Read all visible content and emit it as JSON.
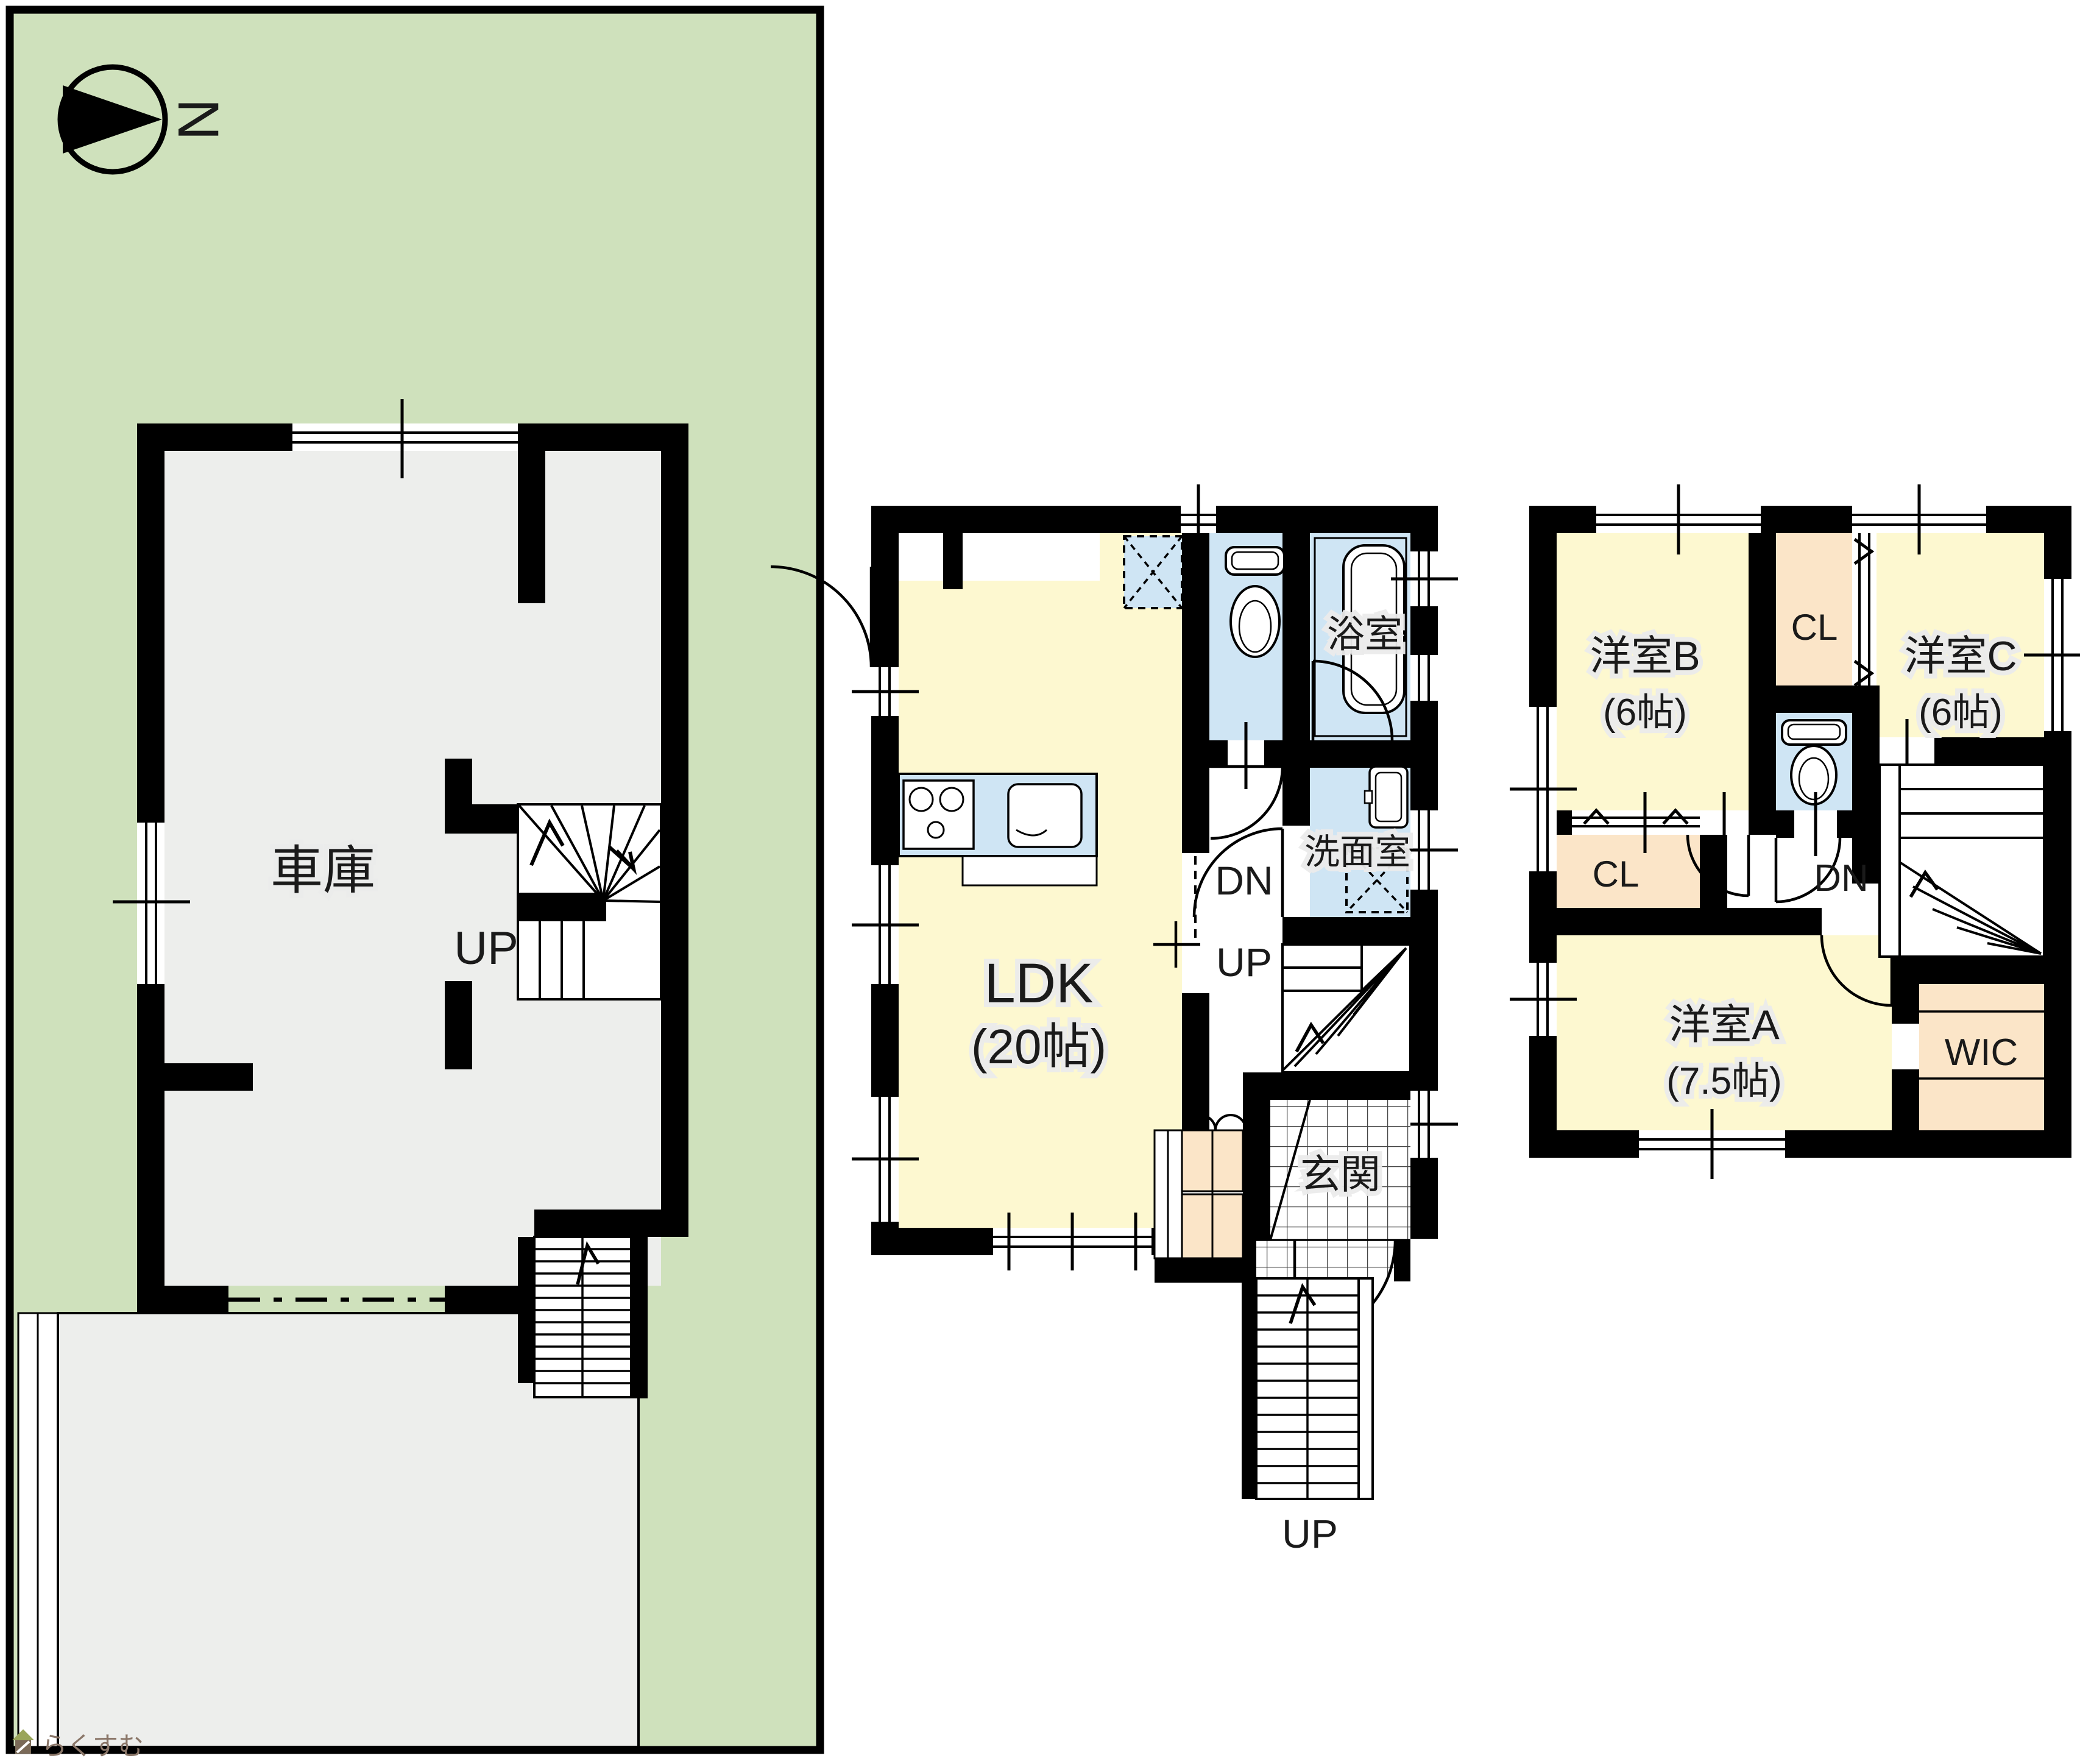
{
  "compass": {
    "north_label": "N"
  },
  "garage_plan": {
    "room_label": "車庫",
    "stair_label": "UP"
  },
  "first_floor_plan": {
    "ldk_label": "LDK",
    "ldk_size": "(20帖)",
    "bath_label": "浴室",
    "washroom_label": "洗面室",
    "entrance_label": "玄関",
    "stair_down_label": "DN",
    "stair_up_label": "UP",
    "outdoor_stair_label": "UP"
  },
  "second_floor_plan": {
    "room_a_label": "洋室A",
    "room_a_size": "(7.5帖)",
    "room_b_label": "洋室B",
    "room_b_size": "(6帖)",
    "room_c_label": "洋室C",
    "room_c_size": "(6帖)",
    "closet_top_label": "CL",
    "closet_b_label": "CL",
    "wic_label": "WIC",
    "stair_down_label": "DN"
  },
  "watermark": {
    "text": "らくすむ"
  },
  "colors": {
    "lot": "#cfe1bc",
    "floor": "#edeeec",
    "room": "#fdf8d0",
    "wet": "#cfe5f4",
    "closet": "#fbe5c8",
    "wall": "#000000",
    "text": "#1a1a1a",
    "watermark": "#8a7668"
  }
}
